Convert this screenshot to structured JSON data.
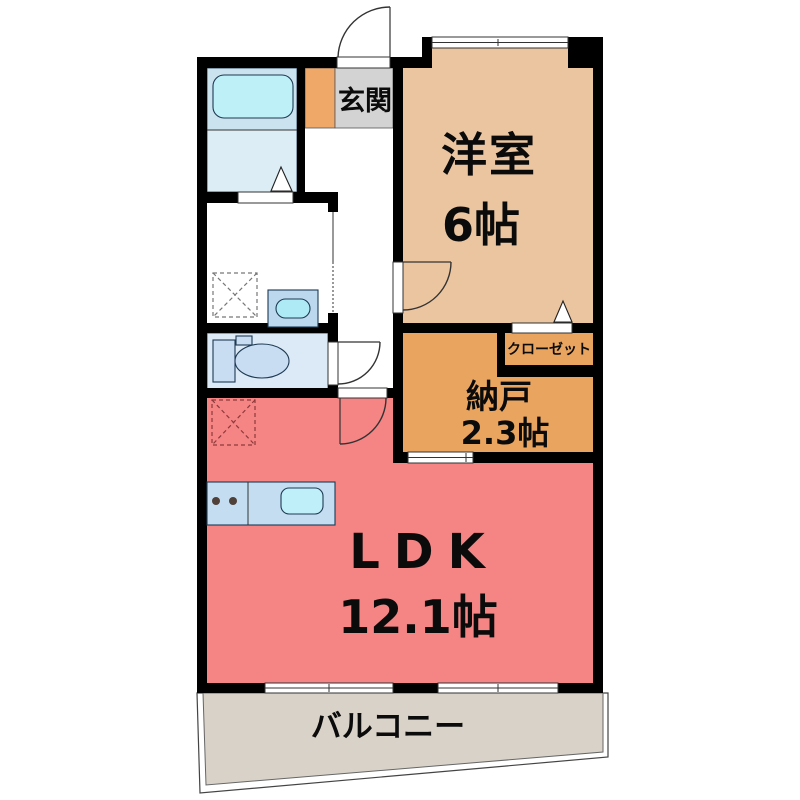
{
  "rooms": {
    "entrance": {
      "label": "玄関"
    },
    "western_room": {
      "label": "洋室",
      "size": "6帖"
    },
    "closet": {
      "label": "クローゼット"
    },
    "storage_room": {
      "label": "納戸",
      "size": "2.3帖"
    },
    "ldk": {
      "label": "LDK",
      "size": "12.1帖"
    },
    "balcony": {
      "label": "バルコニー"
    }
  },
  "colors": {
    "wall": "#000000",
    "western_room": "#EAC5A0",
    "storage_room": "#E9A55F",
    "closet": "#E9A55F",
    "entrance_floor": "#D3D3D3",
    "shoe_cabinet": "#F0A868",
    "ldk": "#F58484",
    "balcony": "#D9D2C8",
    "bath_upper": "#CBE2EF",
    "bath_lower": "#DCEDF6",
    "bathtub": "#BEF0F8",
    "toilet_room": "#DCE9F6",
    "fixture": "#C9DDF2",
    "kitchen_counter": "#C5DDF1",
    "kitchen_sink": "#BFEFF9"
  }
}
